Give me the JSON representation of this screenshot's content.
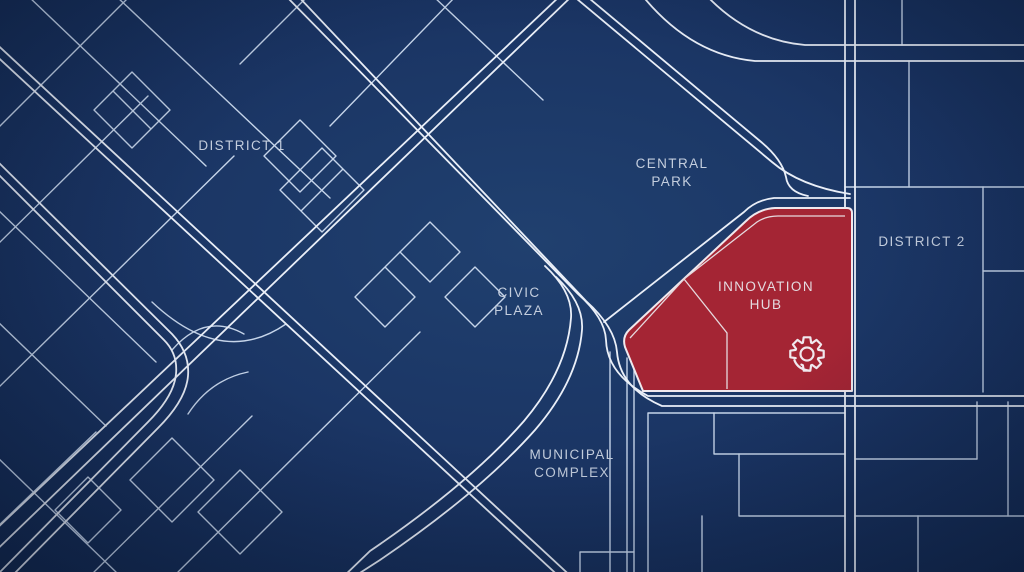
{
  "map": {
    "type": "city-zoning-blueprint-map",
    "labels": {
      "district1": "DISTRICT 1",
      "central_park_line1": "CENTRAL",
      "central_park_line2": "PARK",
      "civic_plaza_line1": "CIVIC",
      "civic_plaza_line2": "PLAZA",
      "municipal_line1": "MUNICIPAL",
      "municipal_line2": "COMPLEX",
      "district2": "DISTRICT 2",
      "hub_line1": "INNOVATION",
      "hub_line2": "HUB"
    },
    "highlight": {
      "name": "Innovation Hub",
      "icon": "gear-icon",
      "fill": "#a42534",
      "border": "#f0e9ee",
      "detail_line": "#e6d9de",
      "label_color": "#e4dbe0"
    },
    "colors": {
      "background_center": "#20406f",
      "background_mid": "#1a3463",
      "background_edge": "#12284e",
      "road_major": "#eaeff8",
      "road_minor": "#c6d5ea",
      "label_text": "#c4cede"
    }
  }
}
